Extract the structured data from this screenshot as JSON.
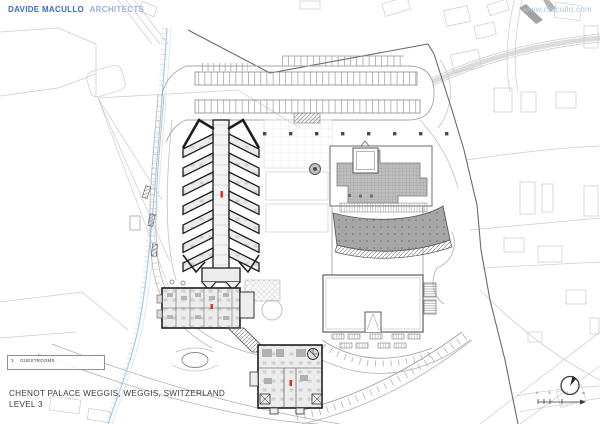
{
  "header": {
    "brand": "DAVIDE MACULLO",
    "brand_suffix": "ARCHITECTS",
    "website": "www.macullo.com"
  },
  "title_block": {
    "project": "CHENOT PALACE WEGGIS, WEGGIS, SWITZERLAND",
    "level": "LEVEL 3"
  },
  "legend": {
    "key_number": "3",
    "key_label": "GUESTROOMS"
  },
  "scale_bar": {
    "labels": [
      "0",
      "5",
      "10",
      "m"
    ]
  },
  "icons": {
    "north_arrow": "north-arrow-icon"
  },
  "colors": {
    "brand_blue": "#3a6cc0",
    "brand_light_blue": "#93b2dd",
    "website_blue": "#a9c6e4",
    "marker_red": "#d9342b",
    "roof_grid_gray": "#bdbdbd",
    "fan_roof_gray": "#a6a6a6",
    "stream_blue": "#a9c7e6",
    "plan_line_dark": "#1e1e1e",
    "context_gray": "#cbcbcb"
  }
}
